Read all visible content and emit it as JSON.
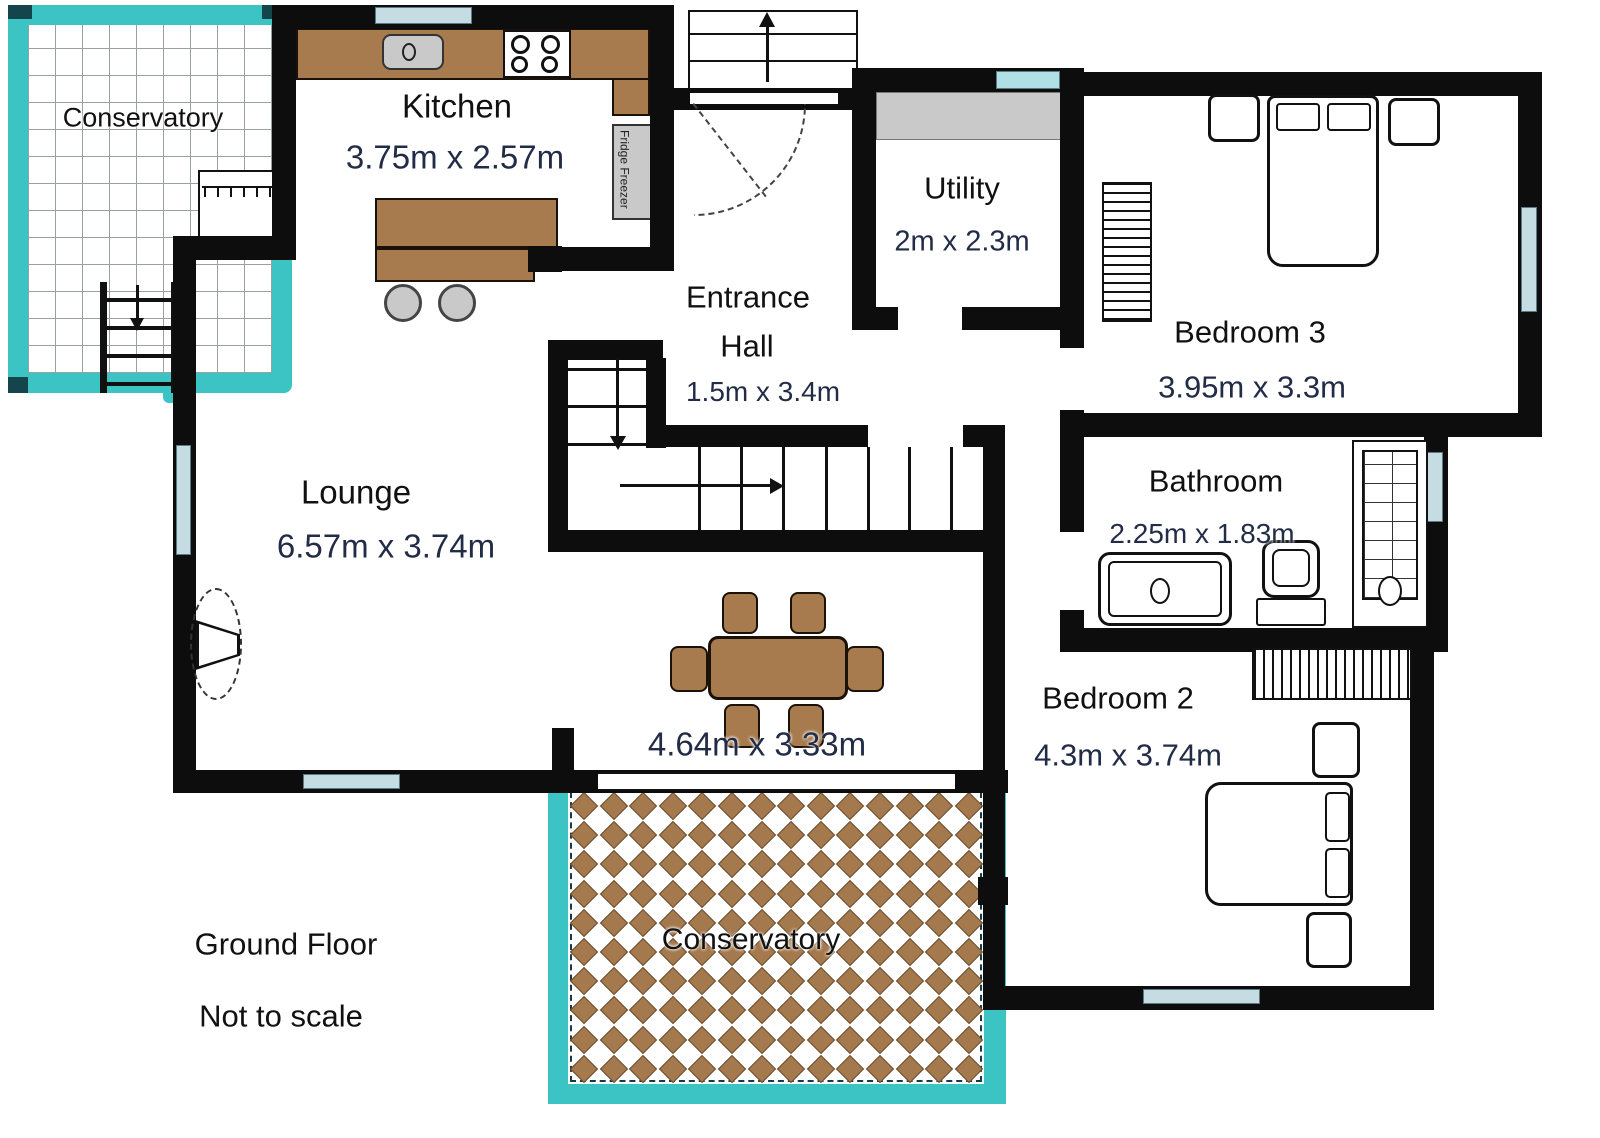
{
  "footer": {
    "floor": "Ground Floor",
    "scale_note": "Not to scale"
  },
  "rooms": {
    "conservatory_top": {
      "name": "Conservatory"
    },
    "kitchen": {
      "name": "Kitchen",
      "dims": "3.75m x 2.57m"
    },
    "entrance_hall": {
      "name_line1": "Entrance",
      "name_line2": "Hall",
      "dims": "1.5m x 3.4m"
    },
    "utility": {
      "name": "Utility",
      "dims": "2m x 2.3m"
    },
    "bedroom3": {
      "name": "Bedroom 3",
      "dims": "3.95m x 3.3m"
    },
    "bathroom": {
      "name": "Bathroom",
      "dims": "2.25m x 1.83m"
    },
    "bedroom2": {
      "name": "Bedroom 2",
      "dims": "4.3m x 3.74m"
    },
    "lounge": {
      "name": "Lounge",
      "dims": "6.57m x 3.74m"
    },
    "dining_area": {
      "dims": "4.64m x 3.33m"
    },
    "conservatory_bottom": {
      "name": "Conservatory"
    }
  },
  "appliances": {
    "fridge_freezer": "Fridge Freezer"
  },
  "icons": {
    "stairs_up_arrow": "arrow-up",
    "stairs_down_arrow": "arrow-down",
    "stairs_right_arrow": "arrow-right",
    "door_swing": "quarter-arc"
  },
  "colors": {
    "wall": "#0d0d0d",
    "conservatory_frame": "#3cc4c4",
    "wood": "#a87b4e",
    "diamond": "#a5794e",
    "fixture_gray": "#c9c9c9",
    "window": "#c5dde2",
    "room_text": "#111111",
    "dimension_text": "#232c47"
  }
}
